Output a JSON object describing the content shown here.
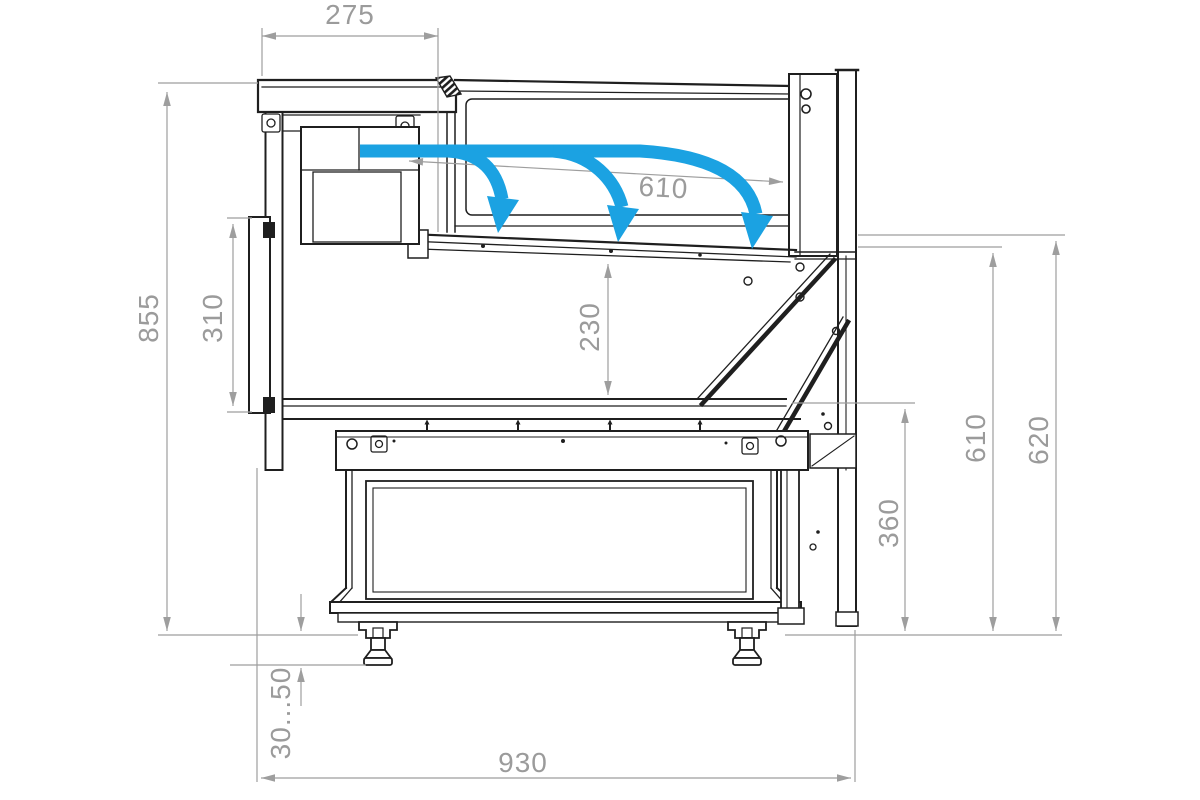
{
  "drawing": {
    "type": "technical-cross-section",
    "subject": "refrigerated display counter side section with airflow"
  },
  "colors": {
    "airflow_blue": "#1ba2e2",
    "dimension_gray": "#9e9e9e",
    "label_gray": "#9b9b9b",
    "line_dark": "#1f1f1f",
    "background": "#ffffff"
  },
  "dimensions": {
    "canopy_width": "275",
    "deck_length": "610",
    "overall_height": "855",
    "front_panel_height": "310",
    "well_depth": "230",
    "base_section_height": "360",
    "deck_level_height": "610",
    "counter_top_height": "620",
    "foot_adjustment_range": "30...50",
    "overall_depth": "930"
  },
  "icons": [
    {
      "name": "airflow-arrow",
      "shape": "curved blue arrow",
      "count": 3
    }
  ]
}
